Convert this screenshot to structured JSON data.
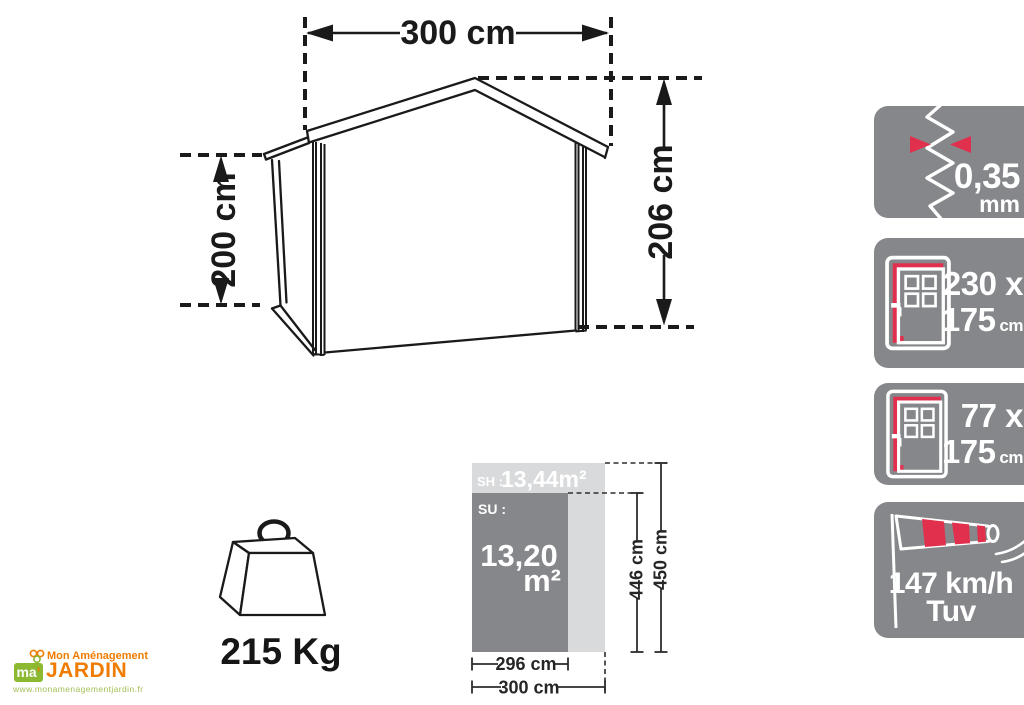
{
  "colors": {
    "line": "#1a1a1a",
    "accent_red": "#e0304e",
    "badge_gray": "#85878a",
    "floor_light_gray": "#d9dadb",
    "floor_dark_gray": "#85878a",
    "logo_orange": "#ef7c00",
    "logo_green": "#8cb832",
    "logo_url_green": "#a4bd55"
  },
  "shed_diagram": {
    "width": "300 cm",
    "wall_height": "200 cm",
    "ridge_height": "206 cm"
  },
  "weight": {
    "value": "215 Kg"
  },
  "floor_plan": {
    "sh_label": "SH :",
    "sh_value": "13,44m²",
    "su_label": "SU :",
    "su_value": "13,20",
    "su_unit": "m²",
    "inner_width": "296 cm",
    "outer_width": "300 cm",
    "inner_length": "446 cm",
    "outer_length": "450 cm"
  },
  "spec_badges": [
    {
      "name": "wall-thickness",
      "value": "0,35",
      "unit": "mm"
    },
    {
      "name": "double-door-size",
      "line1": "230 x",
      "value2": "175",
      "unit2": "cm"
    },
    {
      "name": "single-door-size",
      "line1": "77 x",
      "value2": "175",
      "unit2": "cm"
    },
    {
      "name": "wind-resistance",
      "speed": "147 km/h",
      "cert": "Tuv"
    }
  ],
  "logo": {
    "brand_top": "Mon Aménagement",
    "brand_main": "JARDIN",
    "monogram": "ma",
    "monogram_mark": "’",
    "url": "www.monamenagementjardin.fr"
  }
}
